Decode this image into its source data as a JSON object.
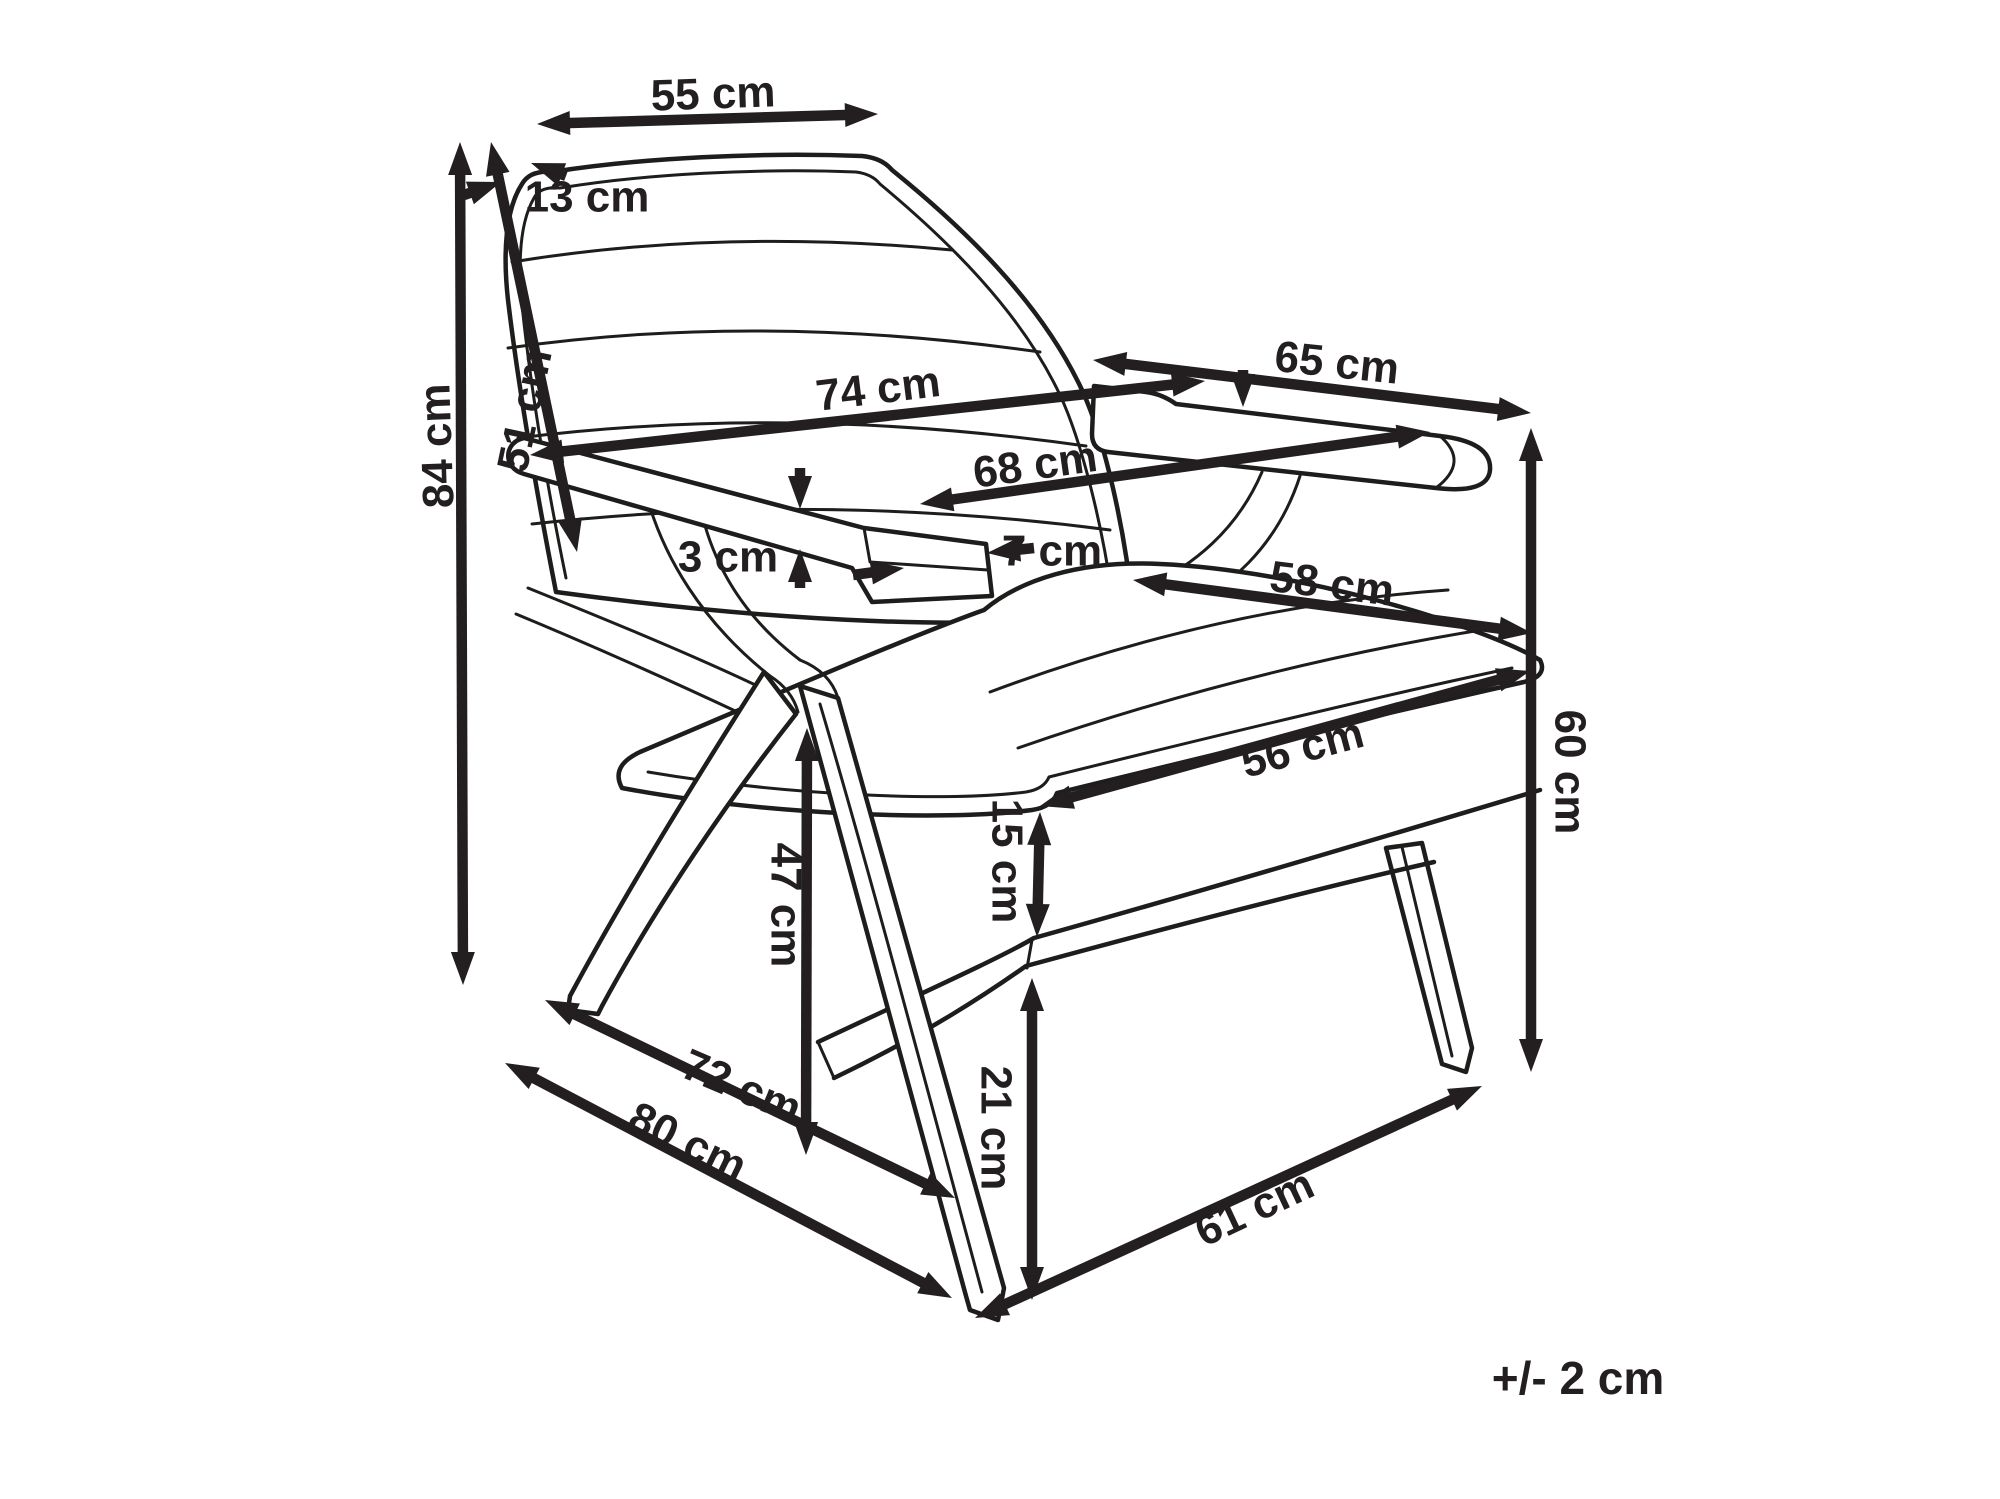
{
  "tolerance_note": "+/- 2 cm",
  "colors": {
    "line": "#231f20",
    "background": "#ffffff"
  },
  "dimensions": [
    {
      "id": "backrest-width-top",
      "label": "55 cm",
      "label_pos": [
        713,
        93
      ],
      "label_rot": -2,
      "arrows": [
        {
          "from": [
            537,
            124
          ],
          "to": [
            878,
            114
          ],
          "head_start": true,
          "head_end": true
        }
      ]
    },
    {
      "id": "backrest-thickness",
      "label": "13 cm",
      "label_pos": [
        587,
        196
      ],
      "label_rot": 0,
      "arrows": [
        {
          "from": [
            464,
            195
          ],
          "to": [
            501,
            182
          ],
          "head_start": false,
          "head_end": true
        },
        {
          "from": [
            566,
            176
          ],
          "to": [
            531,
            163
          ],
          "head_start": false,
          "head_end": true
        }
      ]
    },
    {
      "id": "total-height",
      "label": "84 cm",
      "label_pos": [
        436,
        446
      ],
      "label_rot": -92,
      "arrows": [
        {
          "from": [
            460,
            142
          ],
          "to": [
            463,
            985
          ],
          "head_start": true,
          "head_end": true
        }
      ]
    },
    {
      "id": "backrest-height",
      "label": "51 cm",
      "label_pos": [
        524,
        410
      ],
      "label_rot": -78,
      "arrows": [
        {
          "from": [
            491,
            142
          ],
          "to": [
            577,
            552
          ],
          "head_start": true,
          "head_end": true
        }
      ]
    },
    {
      "id": "total-width",
      "label": "74 cm",
      "label_pos": [
        878,
        388
      ],
      "label_rot": -7,
      "arrows": [
        {
          "from": [
            530,
            455
          ],
          "to": [
            1205,
            381
          ],
          "head_start": true,
          "head_end": true
        }
      ]
    },
    {
      "id": "depth-top",
      "label": "65 cm",
      "label_pos": [
        1337,
        362
      ],
      "label_rot": 6,
      "arrows": [
        {
          "from": [
            1093,
            360
          ],
          "to": [
            1531,
            413
          ],
          "head_start": true,
          "head_end": true
        }
      ]
    },
    {
      "id": "inner-width",
      "label": "68 cm",
      "label_pos": [
        1035,
        464
      ],
      "label_rot": -8,
      "arrows": [
        {
          "from": [
            920,
            504
          ],
          "to": [
            1430,
            432
          ],
          "head_start": true,
          "head_end": true
        }
      ]
    },
    {
      "id": "armrest-thickness",
      "label": "3 cm",
      "label_pos": [
        728,
        556
      ],
      "label_rot": 0,
      "arrows": [
        {
          "from": [
            800,
            468
          ],
          "to": [
            800,
            509
          ],
          "head_start": false,
          "head_end": true
        },
        {
          "from": [
            800,
            588
          ],
          "to": [
            800,
            549
          ],
          "head_start": false,
          "head_end": true
        }
      ]
    },
    {
      "id": "armrest-width",
      "label": "7 cm",
      "label_pos": [
        1052,
        550
      ],
      "label_rot": 0,
      "arrows": [
        {
          "from": [
            853,
            575
          ],
          "to": [
            904,
            568
          ],
          "head_start": false,
          "head_end": true
        },
        {
          "from": [
            1034,
            548
          ],
          "to": [
            987,
            553
          ],
          "head_start": false,
          "head_end": true
        }
      ]
    },
    {
      "id": "seat-depth",
      "label": "58 cm",
      "label_pos": [
        1332,
        583
      ],
      "label_rot": 7,
      "arrows": [
        {
          "from": [
            1133,
            580
          ],
          "to": [
            1532,
            633
          ],
          "head_start": true,
          "head_end": true
        }
      ]
    },
    {
      "id": "seat-width",
      "label": "56 cm",
      "label_pos": [
        1302,
        747
      ],
      "label_rot": -15,
      "arrows": [
        {
          "from": [
            1040,
            806
          ],
          "to": [
            1530,
            671
          ],
          "head_start": true,
          "head_end": true
        }
      ]
    },
    {
      "id": "cushion-height",
      "label": "15 cm",
      "label_pos": [
        1008,
        861
      ],
      "label_rot": 90,
      "arrows": [
        {
          "from": [
            1040,
            812
          ],
          "to": [
            1037,
            937
          ],
          "head_start": true,
          "head_end": true
        }
      ]
    },
    {
      "id": "armrest-height",
      "label": "60 cm",
      "label_pos": [
        1571,
        772
      ],
      "label_rot": 90,
      "arrows": [
        {
          "from": [
            1531,
            428
          ],
          "to": [
            1531,
            1072
          ],
          "head_start": true,
          "head_end": true
        }
      ]
    },
    {
      "id": "seat-height",
      "label": "47 cm",
      "label_pos": [
        787,
        905
      ],
      "label_rot": 90,
      "arrows": [
        {
          "from": [
            807,
            728
          ],
          "to": [
            806,
            1155
          ],
          "head_start": true,
          "head_end": true
        }
      ]
    },
    {
      "id": "clearance-height",
      "label": "21 cm",
      "label_pos": [
        997,
        1128
      ],
      "label_rot": 90,
      "arrows": [
        {
          "from": [
            1032,
            978
          ],
          "to": [
            1032,
            1300
          ],
          "head_start": true,
          "head_end": true
        }
      ]
    },
    {
      "id": "leg-span-depth",
      "label": "72 cm",
      "label_pos": [
        742,
        1086
      ],
      "label_rot": 23,
      "arrows": [
        {
          "from": [
            545,
            1000
          ],
          "to": [
            955,
            1198
          ],
          "head_start": true,
          "head_end": true
        }
      ]
    },
    {
      "id": "total-depth",
      "label": "80 cm",
      "label_pos": [
        688,
        1141
      ],
      "label_rot": 26,
      "arrows": [
        {
          "from": [
            505,
            1063
          ],
          "to": [
            952,
            1298
          ],
          "head_start": true,
          "head_end": true
        }
      ]
    },
    {
      "id": "front-leg-span",
      "label": "61 cm",
      "label_pos": [
        1254,
        1207
      ],
      "label_rot": -25,
      "arrows": [
        {
          "from": [
            975,
            1318
          ],
          "to": [
            1482,
            1086
          ],
          "head_start": true,
          "head_end": true
        }
      ]
    },
    {
      "id": "armrest-top-indicator",
      "label": "",
      "label_pos": [
        0,
        0
      ],
      "label_rot": 0,
      "arrows": [
        {
          "from": [
            1243,
            370
          ],
          "to": [
            1243,
            407
          ],
          "head_start": false,
          "head_end": true
        }
      ]
    }
  ]
}
